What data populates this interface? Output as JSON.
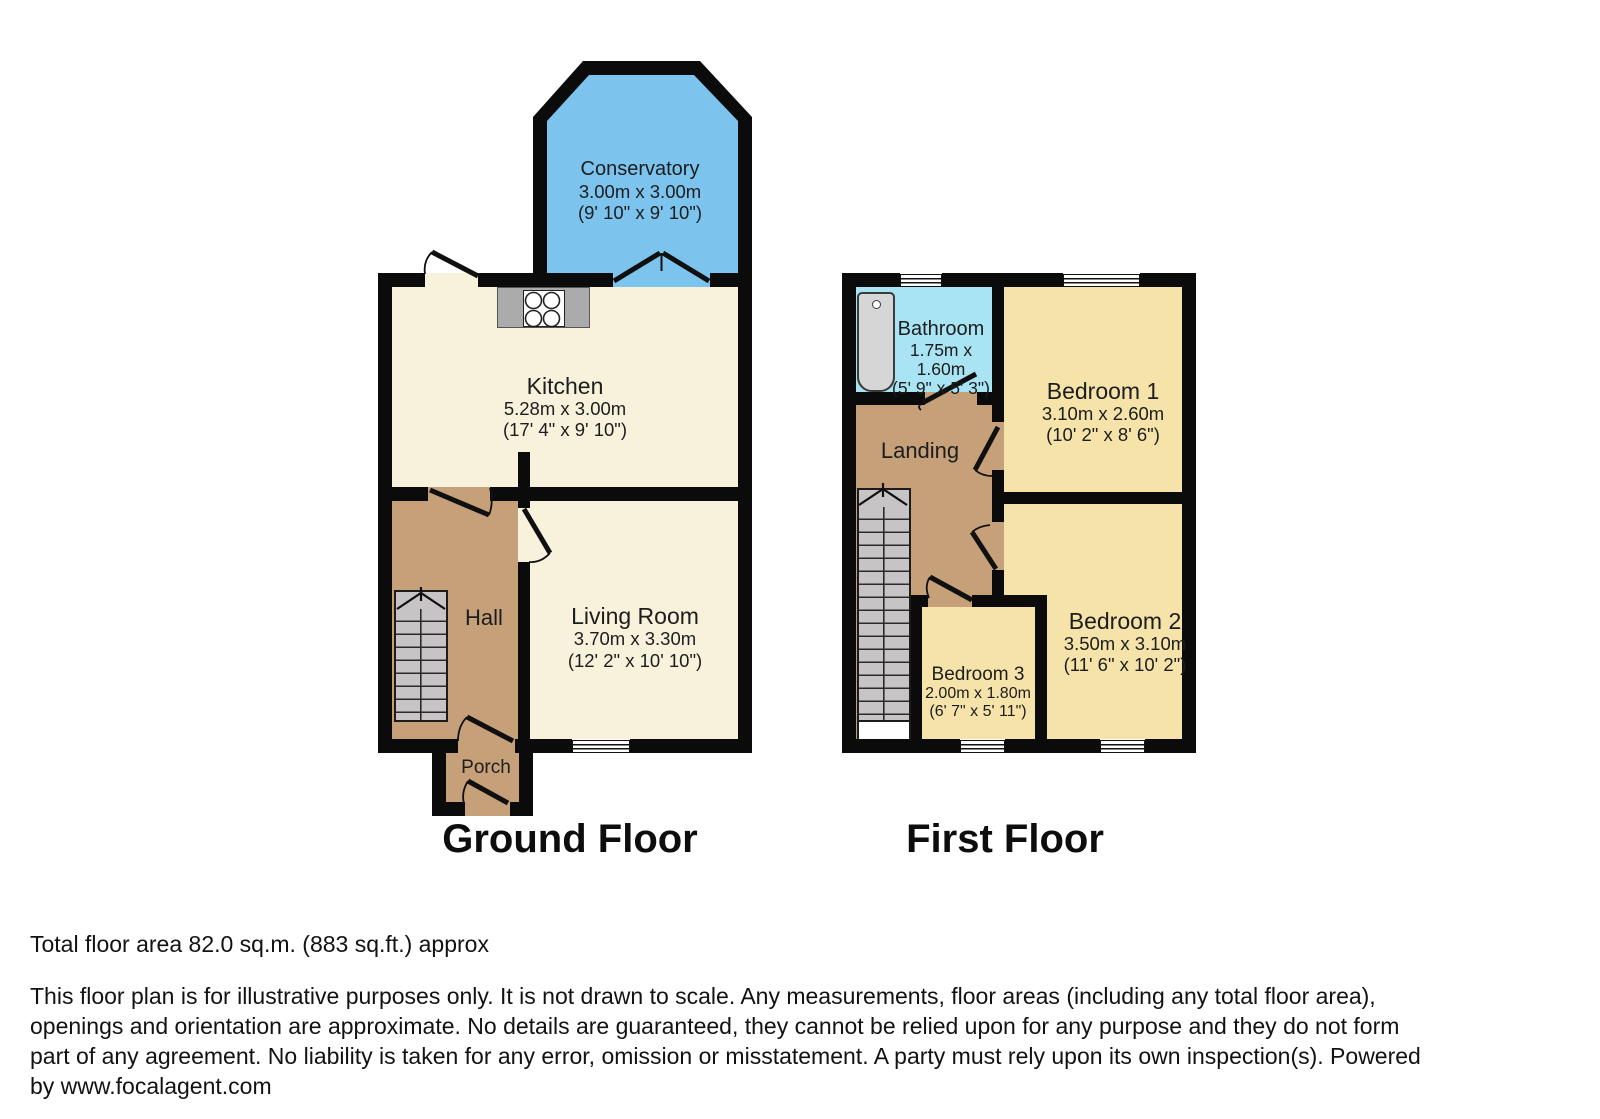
{
  "colors": {
    "wall": "#0b0b0b",
    "conservatory_blue": "#7cc3ed",
    "bathroom_cyan": "#a8e4f4",
    "bedroom_yellow": "#f5e3a9",
    "cream": "#f8f1dc",
    "hall_tan": "#c6a078",
    "stairs_gray": "#c6c4c4",
    "cooktop_gray": "#ababab",
    "tub_gray": "#d6d6d6"
  },
  "ground_floor": {
    "title": "Ground Floor",
    "rooms": {
      "conservatory": {
        "name": "Conservatory",
        "dims_m": "3.00m x 3.00m",
        "dims_ft": "(9' 10\" x 9' 10\")"
      },
      "kitchen": {
        "name": "Kitchen",
        "dims_m": "5.28m x 3.00m",
        "dims_ft": "(17' 4\" x 9' 10\")"
      },
      "hall": {
        "name": "Hall"
      },
      "living_room": {
        "name": "Living Room",
        "dims_m": "3.70m x 3.30m",
        "dims_ft": "(12' 2\" x 10' 10\")"
      },
      "porch": {
        "name": "Porch"
      }
    }
  },
  "first_floor": {
    "title": "First Floor",
    "rooms": {
      "bathroom": {
        "name": "Bathroom",
        "dims_m_line1": "1.75m x",
        "dims_m_line2": "1.60m",
        "dims_ft": "(5' 9\" x 5' 3\")"
      },
      "bedroom1": {
        "name": "Bedroom 1",
        "dims_m": "3.10m x 2.60m",
        "dims_ft": "(10' 2\" x 8' 6\")"
      },
      "landing": {
        "name": "Landing"
      },
      "bedroom2": {
        "name": "Bedroom 2",
        "dims_m": "3.50m x 3.10m",
        "dims_ft": "(11' 6\" x 10' 2\")"
      },
      "bedroom3": {
        "name": "Bedroom 3",
        "dims_m": "2.00m x 1.80m",
        "dims_ft": "(6' 7\" x 5' 11\")"
      }
    }
  },
  "footer": {
    "total_area": "Total floor area 82.0 sq.m. (883 sq.ft.) approx",
    "disclaimer_lines": [
      "This floor plan is for illustrative purposes only. It is not drawn to scale. Any measurements, floor areas (including any total floor area),",
      "openings and orientation are approximate. No details are guaranteed, they cannot be relied upon for any purpose and they do not form",
      "part of any agreement. No liability is taken for any error, omission or misstatement. A party must rely upon its own inspection(s). Powered",
      "by www.focalagent.com"
    ]
  }
}
